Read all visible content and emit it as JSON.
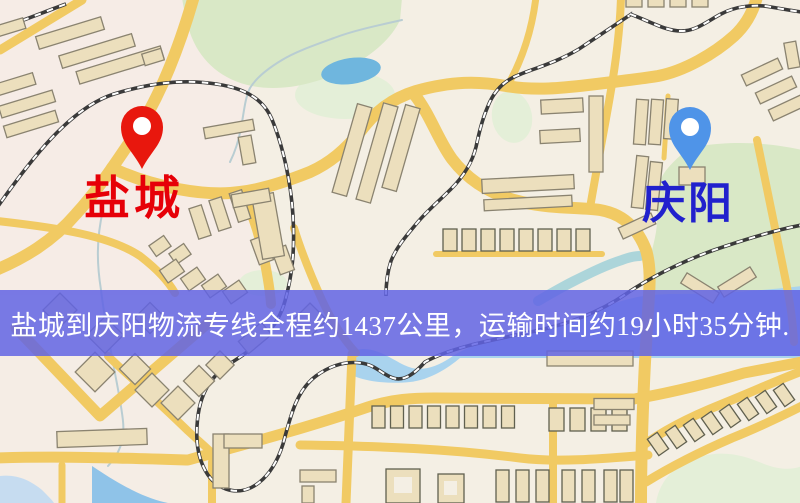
{
  "route": {
    "origin": "盐城",
    "destination": "庆阳",
    "distance_text": "约1437公里",
    "duration_text": "约19小时35分钟"
  },
  "banner": {
    "text": "盐城到庆阳物流专线全程约1437公里，运输时间约19小时35分钟."
  },
  "palette": {
    "map-bg": "#f4efe4",
    "tint-pink": "#f8e9e7",
    "road": "#f1ca63",
    "building-fill": "#ecdfbd",
    "building-stroke": "#8a8370",
    "building-stroke-dark": "#60604f",
    "green": "#d9e8c6",
    "green-light": "#e4efd8",
    "pond": "#6fb6de",
    "water": "#a9d3ee",
    "water-deep": "#8fc3e8",
    "water-corner": "#c6dcf0",
    "stream": "#b9cdd2",
    "teal-arm": "#9fd0d8",
    "rail-dark": "#3a3a3a",
    "rail-light": "#ffffff",
    "pin-origin": "#e8170d",
    "pin-destination": "#4f94e8",
    "label-origin": "#e60008",
    "label-destination": "#2121cd",
    "banner-bg": "#6163e4d8",
    "banner-text": "#ffffff"
  }
}
